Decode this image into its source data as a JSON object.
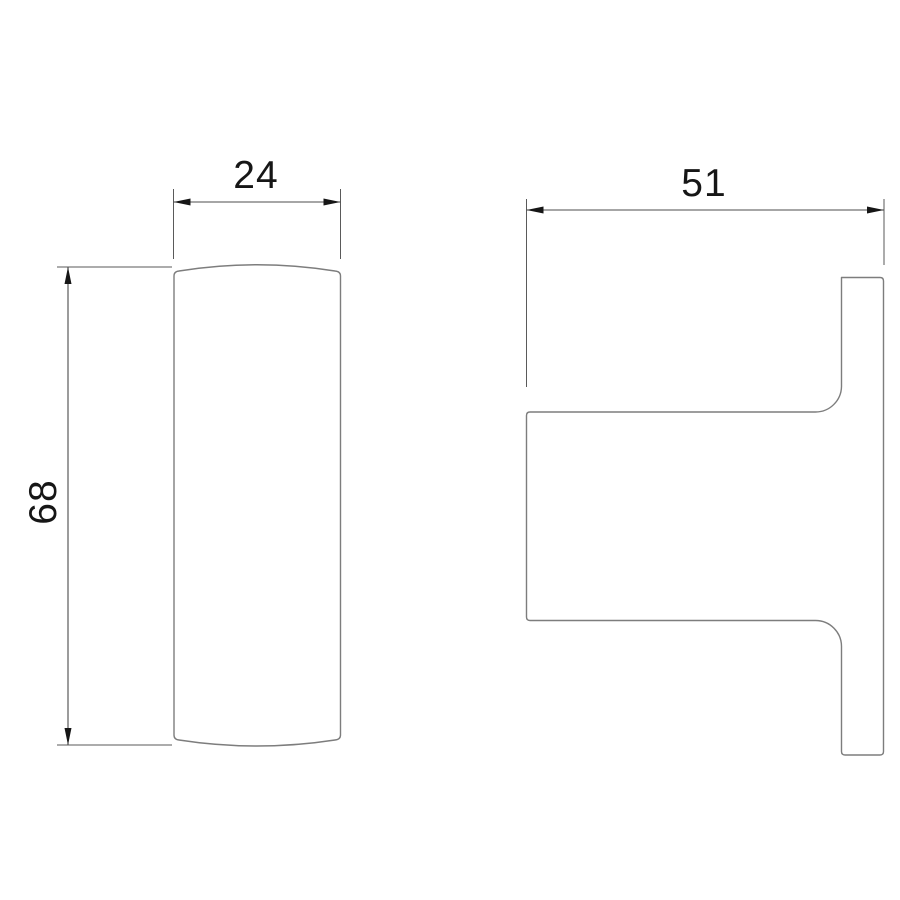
{
  "drawing": {
    "kind": "orthographic technical drawing of wall hook",
    "views": {
      "front_view": "rounded vertical bar",
      "side_view": "hook profile with wall plate"
    }
  },
  "dimensions": {
    "width": "24",
    "depth": "51",
    "height": "68"
  },
  "colors": {
    "background": "#ffffff",
    "outline": "#7d7d7d",
    "dimension_lines": "#4c4c4c",
    "text_and_arrows": "#161616"
  }
}
